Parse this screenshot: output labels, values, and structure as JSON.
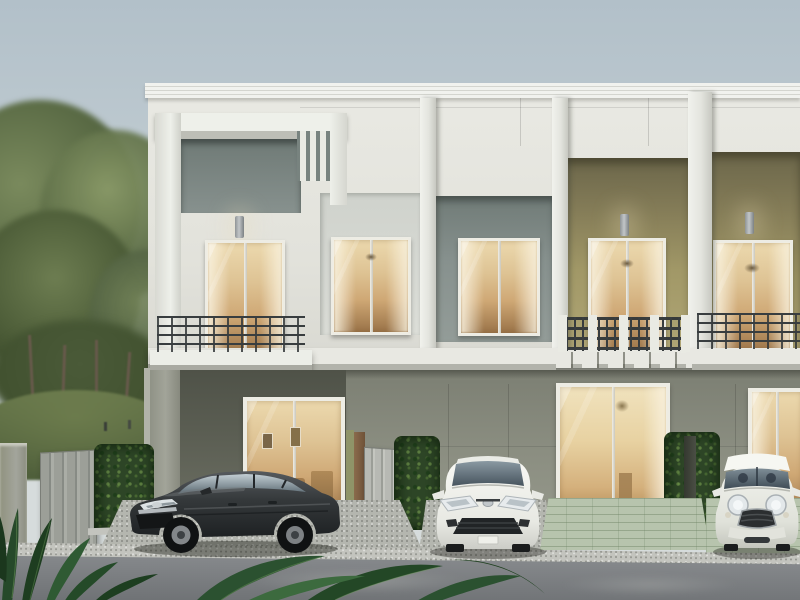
{
  "scene": {
    "type": "architectural-exterior-render",
    "description": "Daytime front-elevation rendering of a modern two-storey townhome row. White parapet facade with grey-green feature panels, vertical fin details and olive accent walls; warm-lit windows and sliding glass doors; balconies with dark metal railings; trimmed hedges and grey folding gates between car pads; a park with trees on the left; three cars parked in front: a dark grey sedan, a white compact sedan and a white mini hatchback; asphalt road and tropical foliage in the foreground.",
    "time_of_day": "overcast daylight",
    "building": {
      "storeys": 2,
      "units": [
        {
          "name": "unit-1",
          "upper": "white portal frame, grey-green panel with three vertical fins, balcony door and window, dark horizontal-bar balcony railing, wall sconce",
          "lower": "recessed carport with warm-lit sliding glass door to living room"
        },
        {
          "name": "unit-2",
          "upper": "window on grey-green panel plus balcony door on olive wall, white posts with dark vertical-bar railing over corbels, wall sconce",
          "lower": "sliding glass door with chandelier-lit dining room, green tile patio"
        },
        {
          "name": "unit-3",
          "upper": "balcony door on olive wall, dark metal grid railing, wall sconce",
          "lower": "sliding glass door behind parked mini hatchback"
        }
      ]
    },
    "cars": [
      {
        "name": "dark-grey-sedan",
        "style": "mid-size saloon, three-quarter front view, parked in left carport",
        "color_key": "car_dark"
      },
      {
        "name": "white-compact-sedan",
        "style": "compact saloon, front view, parked on middle pad",
        "color_key": "car_white"
      },
      {
        "name": "white-mini-hatchback",
        "style": "retro mini with white roof, front view, parked on right pad",
        "color_key": "mini_white"
      }
    ],
    "landscape": {
      "left": "park with lawn mound, staked young trees and large canopies, two distant figures",
      "boundary": "clipped hedges and grey folding gates between units, concrete posts",
      "foreground": "speckled concrete aprons, green tile patios, grey asphalt road, dark tropical leaves at bottom edge"
    }
  },
  "colors": {
    "sky_top": "#b2c0c9",
    "sky_horizon": "#ccd5d8",
    "facade_white": "#e9e9e3",
    "facade_shade": "#d8d8d1",
    "cornice_white": "#f1f2ee",
    "panel_grey": "#87918e",
    "panel_grey_deep": "#707b77",
    "olive_top": "#6b664a",
    "olive_mid": "#a19867",
    "olive_low": "#b0a675",
    "ground_wall_top": "#7c7f73",
    "ground_wall": "#8b8e81",
    "carport_dark": "#5a5d52",
    "pillar_light": "#a2a499",
    "slab_white": "#e8e8e2",
    "slab_under": "#b2b3ab",
    "railing_dark": "#383d3f",
    "frame_white": "#edece4",
    "glass_top": "#ecd9ae",
    "glass_mid": "#cfa875",
    "glass_low": "#9a7348",
    "hedge_base": "#2d4526",
    "park_grass": "#66764a",
    "park_dark": "#41512f",
    "canopy_green": "#4e5f3c",
    "canopy_lit": "#7a8a5d",
    "trunk_brown": "#66594a",
    "gate_grey": "#9c9f98",
    "post_olive": "#8f9468",
    "post_wood": "#8a6b4c",
    "apron_grey": "#b4b6af",
    "patio_green": "#b7c4ad",
    "curb_light": "#c3c4be",
    "road_top": "#85888b",
    "road_low": "#6c6f72",
    "car_dark": "#35393b",
    "car_white": "#f1f1ec",
    "mini_white": "#e9eae4",
    "leaf_dark": "#234223",
    "leaf_mid": "#2f5530"
  }
}
